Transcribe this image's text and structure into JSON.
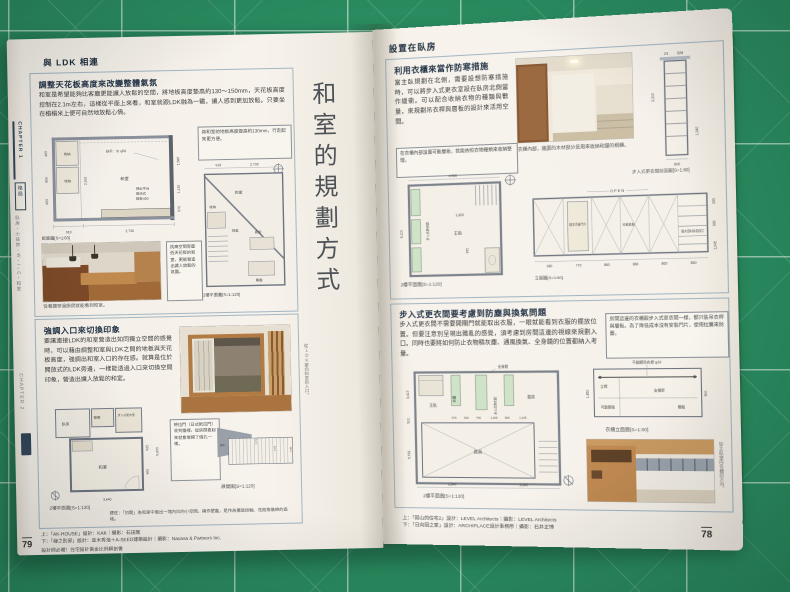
{
  "left_page": {
    "sidebar": {
      "chapter1": "CHAPTER 1",
      "chapter1_label": "格局",
      "items": "臥房・小孩房・W・I・C・和室",
      "chapter2": "CHAPTER 2"
    },
    "header": "與 LDK 相連",
    "big_title": "和室的規劃方式",
    "box1": {
      "title": "調整天花板高度來改變整體氣氛",
      "body": "和室是希望能夠比客廳更能讓人放鬆的空間，將地板高度墊高約130～150mm，天花板高度控制在2.1m左右，這樣從平面上來看，和室就跟LDK融為一體，讓人感到更加放鬆。只要坐在榻榻米上便可自然地放鬆心情。",
      "section": {
        "caption": "斷面圖[S=1:60]",
        "labels": {
          "storage": "收納",
          "room": "和室",
          "handrail": "扶手：St φ50",
          "platform": "掃出平台",
          "platform2": "兩段式",
          "platform3": "踏板450"
        },
        "dims": [
          "450",
          "850",
          "650",
          "2,150",
          "1,580",
          "1,130",
          "570",
          "910",
          "2,730"
        ]
      },
      "callout": "將和室的地板高度提高約130mm，行走起來更方便。",
      "plan": {
        "caption": "2樓平面圖[S=1:120]",
        "labels": {
          "room": "和室",
          "storage": "收納",
          "void": "挑高",
          "kitchen": "廚房",
          "dining": "餐廳"
        },
        "dims": [
          "910",
          "2,730"
        ]
      },
      "photo_caption": "從餐廳穿過廚房就能看到和室。",
      "photo_note": "挑高空間旁壓低天花板的和室，更能營造出讓人放鬆的氛圍。"
    },
    "box2": {
      "title": "強調入口來切換印象",
      "body": "要讓連接LDK的和室營造出如同獨立空間的感覺時，可以藉由調整和室與LDK之間的地板與天花板高度，強調出和室入口的存在感。就算是位於開放式的LDK旁邊，一樣能透過入口來切換空間印象，營造出讓人放鬆的和室。",
      "plan": {
        "caption": "2樓平面圖[S=1:120]",
        "labels": {
          "bedroom": "臥房",
          "closet": "壁櫥",
          "wic": "步入式更衣室",
          "room": "和室"
        },
        "dims": [
          "3,640",
          "620",
          "900",
          "5,600"
        ]
      },
      "elevation": {
        "caption": "展開圖[S=1:120]",
        "labels": {
          "closet": "壁櫥",
          "room": "和室"
        },
        "dims": [
          "3,273",
          "2,250",
          "1,900"
        ]
      },
      "callout": "將拉門（日式紙拉門）收到牆裡，從房間看起來就會像開了個孔一樣。",
      "note": "譯註：「凹間」為和室中做出一塊內凹的小空間，稱作壁龕，是作為擺放掛軸、花瓶等裝飾的區域。",
      "side_caption": "從LDK望向和室的入口。"
    },
    "footer": {
      "credit_top": "上：「AK-HOUSE」設計：KAK｜攝影：石田篤",
      "credit_bottom": "下：「緣之別邸」設計：並木秀浩＋A-SEED建築設計｜攝影：Nacasa & Partners Inc.",
      "book_title": "設計師必備！住宅設計黃金比例解剖書",
      "page_no": "79"
    }
  },
  "right_page": {
    "header": "設置在臥房",
    "boxA": {
      "title": "利用衣櫃來當作防寒措施",
      "body": "當主臥規劃在北側，需要設想防寒措施時，可以將步入式更衣室設在臥房北側當作緩衝。可以配合收納衣物的種類與數量，來規劃吊衣桿與層板的設計來活用空間。",
      "photo_caption": "衣櫃內部，牆面的木材部分是用來收納和服的桐櫃。",
      "callout": "在衣櫃內部設置可動層板，就能依照衣物種類來收納整理。",
      "plan": {
        "caption": "2樓平面圖[S=1:120]",
        "labels": {
          "bedroom": "主臥",
          "wic": "步入式更衣間"
        },
        "dims": [
          "4,550",
          "4,100",
          "1,820",
          "970"
        ]
      },
      "section": {
        "caption": "步入式更衣間剖面圖[S=1:80]",
        "dims": [
          "24",
          "528",
          "2,200",
          "1,340",
          "600"
        ]
      },
      "elevation": {
        "caption": "立面圖[S=1:60]",
        "open_label": "OPEN",
        "labels": {
          "door": "椴木合板門片",
          "shelf": "可動層板",
          "panel": "椴木貼皮",
          "finish": "椴木面材素面加工"
        },
        "dims_bottom": [
          "960",
          "770",
          "860",
          "860",
          "860",
          "860"
        ],
        "dims_right": [
          "200",
          "900",
          "1,045"
        ]
      }
    },
    "boxB": {
      "title": "步入式更衣間要考慮到防塵與換氣問題",
      "body": "步入式更衣間不需要開關門就能取出衣服，一眼就能看到衣服的擺放位置。但要注意別呈現出雜亂的感覺，須考慮到房間這邊的視線來規劃入口。同時也要將如何防止衣物積灰塵、通風換氣、全身鏡的位置都納入考量。",
      "callout": "房間這邊的衣櫃跟步入式更衣間一樣，都只裝吊衣桿與層板。為了降低成本沒有安裝門片，使用拉簾來防塵。",
      "plan": {
        "caption": "2樓平面圖[S=1:120]",
        "labels": {
          "bedroom": "主臥",
          "closet": "衣櫃",
          "wic": "步入式更衣間",
          "study": "書房",
          "void": "挑高",
          "mirror": "全身鏡"
        },
        "dims_bottom": [
          "3,840",
          "3,840"
        ],
        "dims_left": [
          "3,417",
          "910",
          "5,733"
        ],
        "dims_inner": [
          "570",
          "530",
          "740",
          "1,000",
          "500",
          "1,105"
        ]
      },
      "elevation": {
        "caption": "衣櫃立面圖[S=1:60]",
        "labels": {
          "rod": "不鏽鋼吊衣桿 φ30",
          "post": "立桿",
          "bracket": "支撐架",
          "shelf": "可動層板",
          "board": "棚板"
        },
        "dims": [
          "900",
          "1,850"
        ]
      },
      "photo_caption": "從主臥望向衣櫃的方向。"
    },
    "footer": {
      "credit_top": "上：「岡山的住宅2」設計：LEVEL Architects｜攝影：LEVEL Architects",
      "credit_bottom": "下：「日向岡之家」設計：ARCHIPLACE設計事務所｜攝影：石井正博",
      "page_no": "78"
    }
  }
}
